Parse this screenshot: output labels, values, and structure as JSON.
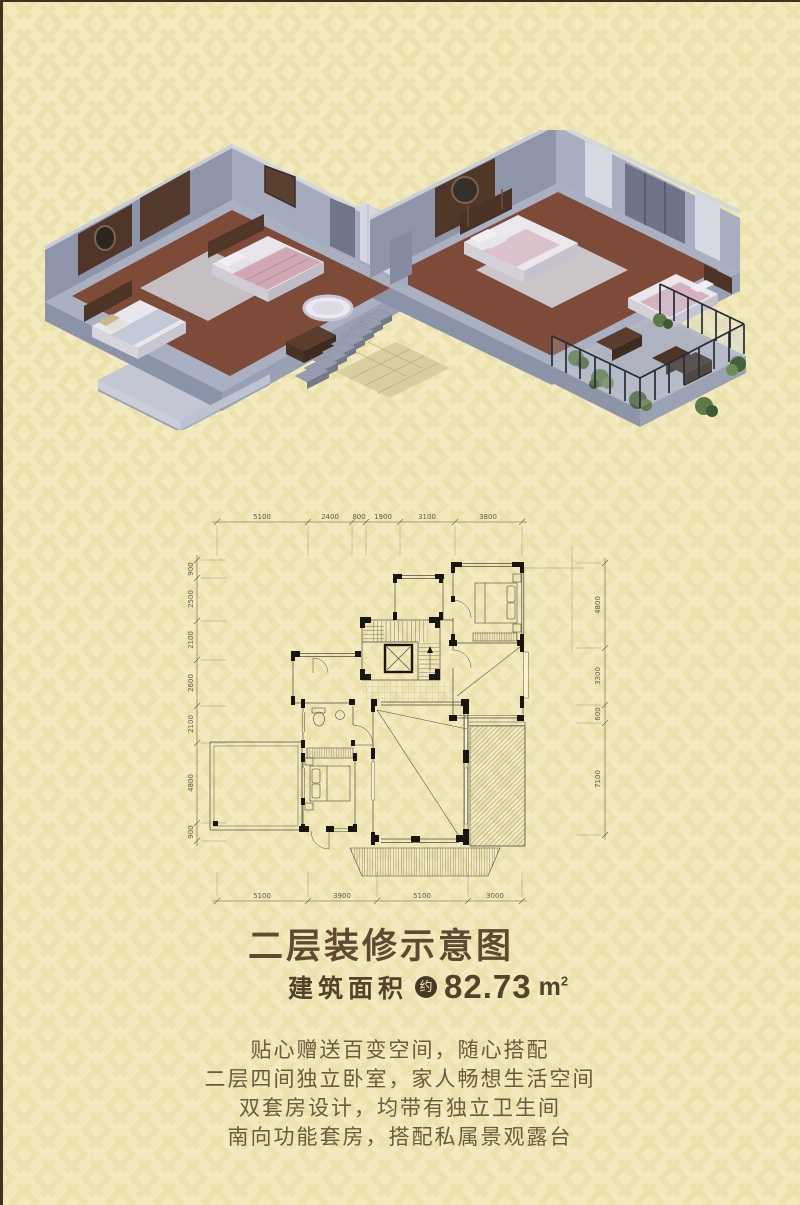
{
  "page": {
    "background_color": "#f2eabc",
    "pattern_color": "#ebe1ab",
    "text_brown": "#5e4a33",
    "plan_line_color": "#4b4b40"
  },
  "floor_plan": {
    "dims_top": [
      "5100",
      "2400",
      "800",
      "1900",
      "3100",
      "3800"
    ],
    "dims_bottom": [
      "5100",
      "3900",
      "5100",
      "3000"
    ],
    "dims_left": [
      "900",
      "2500",
      "2100",
      "2600",
      "2100",
      "4800",
      "900"
    ],
    "dims_right": [
      "4800",
      "3300",
      "600",
      "7100"
    ]
  },
  "info": {
    "title": "二层装修示意图",
    "area_label": "建筑面积",
    "area_badge": "约",
    "area_value": "82.73",
    "area_unit_base": "m",
    "area_unit_exp": "2",
    "description_lines": [
      "贴心赠送百变空间，随心搭配",
      "二层四间独立卧室，家人畅想生活空间",
      "双套房设计，均带有独立卫生间",
      "南向功能套房，搭配私属景观露台"
    ]
  }
}
